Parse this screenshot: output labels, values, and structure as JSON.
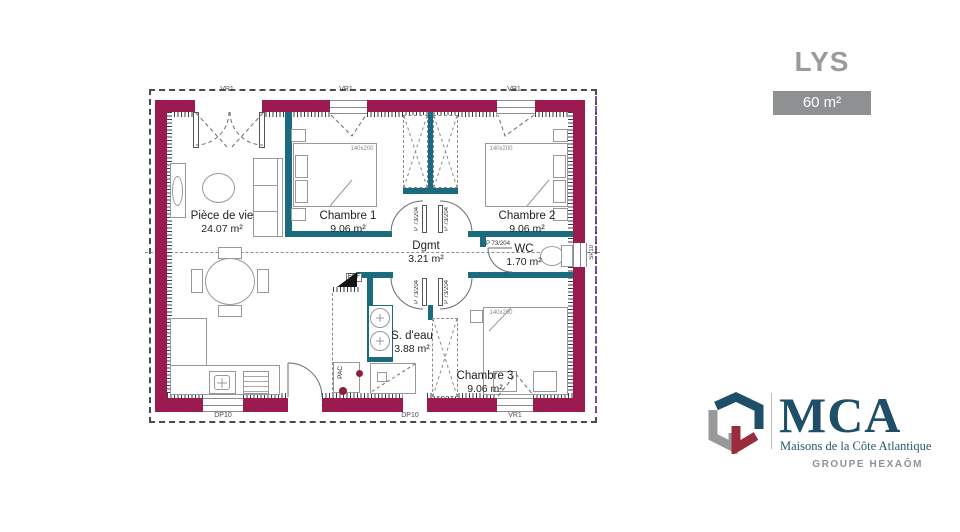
{
  "header": {
    "model_name": "LYS",
    "area_badge": "60 m²"
  },
  "plan": {
    "rooms": [
      {
        "name": "Pièce de vie",
        "area": "24.07 m²"
      },
      {
        "name": "Chambre 1",
        "area": "9.06 m²"
      },
      {
        "name": "Chambre 2",
        "area": "9.06 m²"
      },
      {
        "name": "Dgmt",
        "area": "3.21 m²"
      },
      {
        "name": "WC",
        "area": "1.70 m²"
      },
      {
        "name": "S. d'eau",
        "area": "3.88 m²"
      },
      {
        "name": "Chambre 3",
        "area": "9.06 m²"
      }
    ],
    "labels": {
      "door": "P 73/204",
      "bed": "140x200",
      "edf": "EDF",
      "pac": "PAC",
      "vr": "VR1",
      "sp": "SP10",
      "dp": "DP10"
    },
    "colors": {
      "exterior_wall": "#9b1b51",
      "interior_wall": "#1a6b7e",
      "roof_dash": "#4a4a4a",
      "right_dash": "#7b4fa6"
    }
  },
  "branding": {
    "logo_text": "MCA",
    "logo_subtitle": "Maisons de la Côte Atlantique",
    "group_label": "GROUPE HEXAÔM"
  }
}
